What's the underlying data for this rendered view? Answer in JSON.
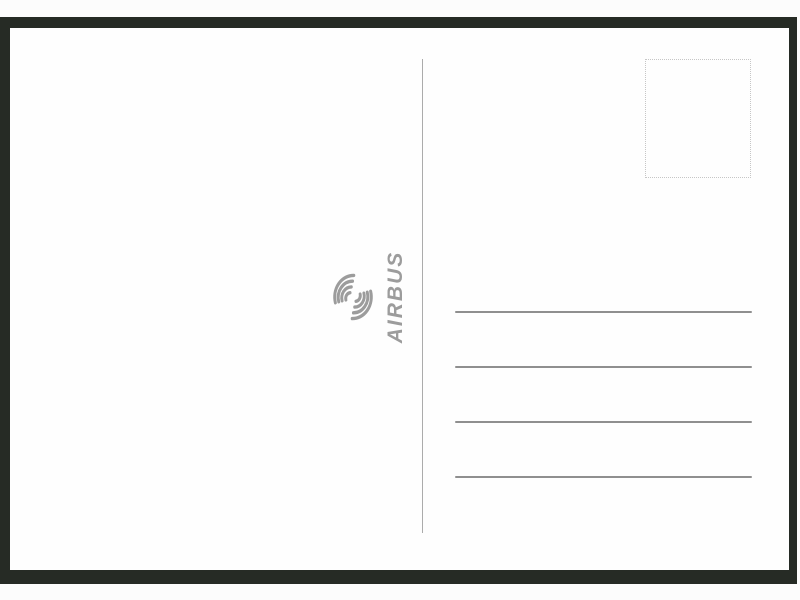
{
  "postcard": {
    "brand_name": "AIRBUS",
    "address_line_count": 4,
    "has_stamp_box": true
  },
  "icons": {
    "logo": "airbus-swirl-icon",
    "stamp": "stamp-placeholder-box"
  },
  "colors": {
    "page_background": "#fcfcfc",
    "mat_background": "#262b25",
    "card_background": "#fefefe",
    "divider": "#ababab",
    "address_line": "#8f8f8f",
    "stamp_border": "#c6c6c6",
    "logo": "#9c9c9c"
  }
}
